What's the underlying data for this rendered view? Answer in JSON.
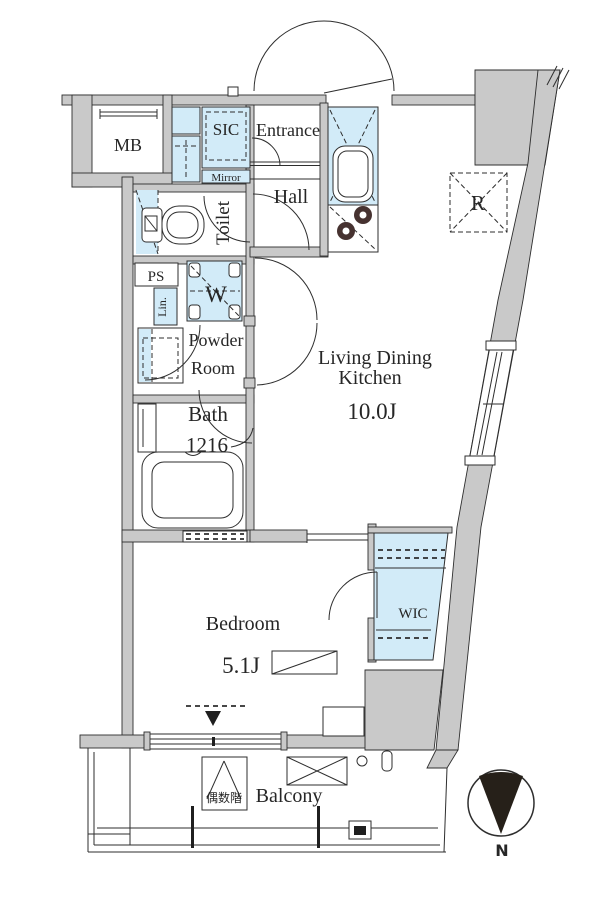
{
  "title": "1K apartment floor plan",
  "labels": {
    "mb": "MB",
    "sic": "SIC",
    "entrance": "Entrance",
    "mirror": "Mirror",
    "hall": "Hall",
    "toilet": "Toilet",
    "ps": "PS",
    "washer": "W",
    "linen": "Lin.",
    "powder1": "Powder",
    "powder2": "Room",
    "bath": "Bath",
    "bath_size": "1216",
    "ldk1": "Living Dining",
    "ldk2": "Kitchen",
    "ldk_size": "10.0J",
    "fridge": "R",
    "wic": "WIC",
    "bedroom": "Bedroom",
    "bedroom_size": "5.1J",
    "balcony": "Balcony",
    "floor_note": "偶数階",
    "compass_north": "N"
  },
  "colors": {
    "wall": "#c9c9c9",
    "line": "#2e2e2e",
    "blue": "#d2ebf8",
    "burner": "#463230",
    "needle": "#262019",
    "text": "#262626",
    "bg": "#ffffff"
  }
}
